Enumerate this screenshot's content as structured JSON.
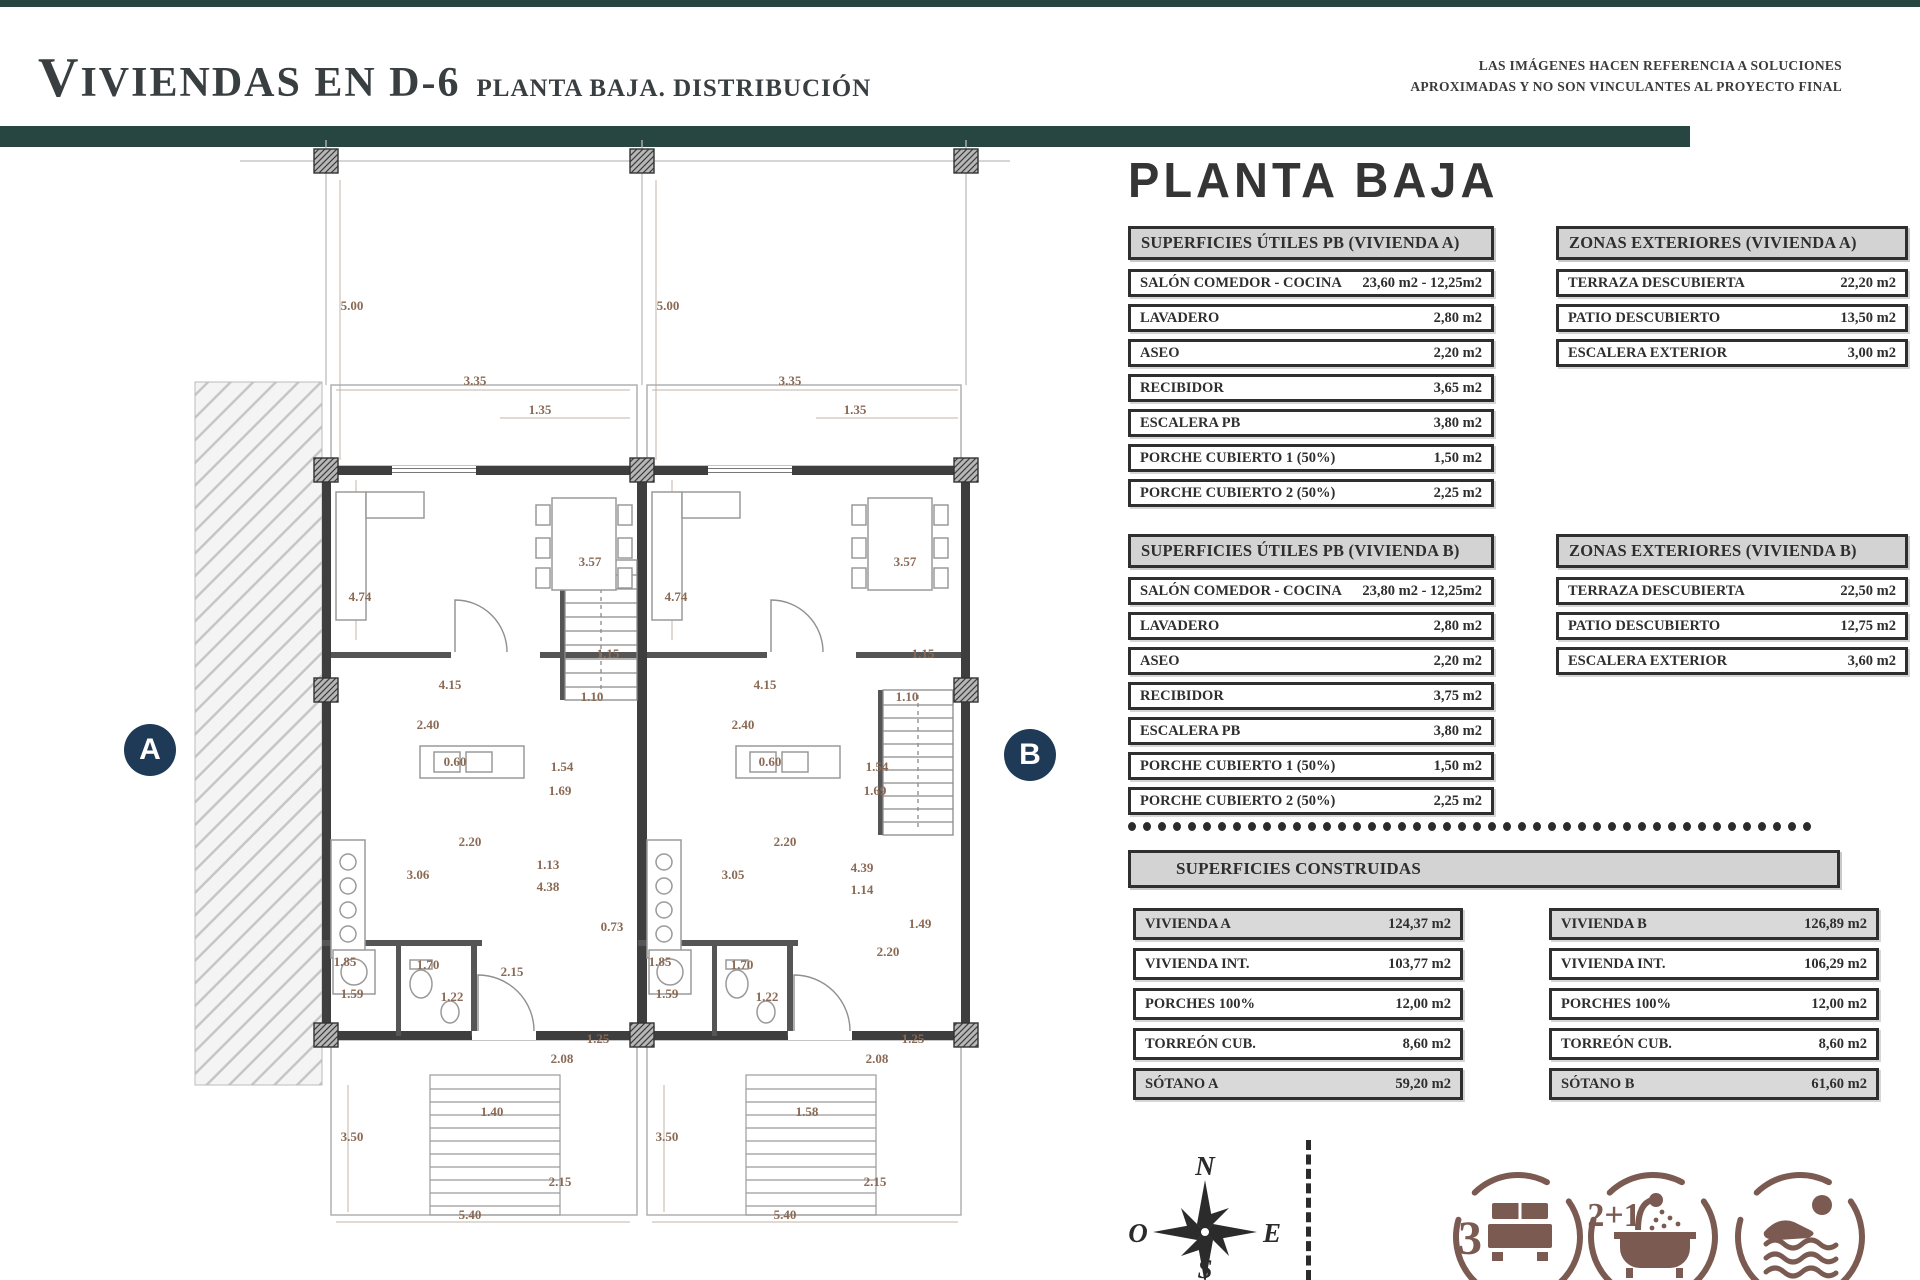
{
  "header": {
    "title_main": "VIVIENDAS EN D-6",
    "title_sub": "PLANTA BAJA. DISTRIBUCIÓN",
    "disclaimer_line1": "LAS IMÁGENES HACEN REFERENCIA A SOLUCIONES",
    "disclaimer_line2": "APROXIMADAS Y NO SON VINCULANTES AL PROYECTO FINAL"
  },
  "panel": {
    "heading": "PLANTA BAJA",
    "tables": [
      {
        "id": "utiles_a",
        "title": "SUPERFICIES ÚTILES PB (VIVIENDA A)",
        "rows": [
          [
            "SALÓN COMEDOR - COCINA",
            "23,60 m2 - 12,25m2"
          ],
          [
            "LAVADERO",
            "2,80 m2"
          ],
          [
            "ASEO",
            "2,20 m2"
          ],
          [
            "RECIBIDOR",
            "3,65 m2"
          ],
          [
            "ESCALERA PB",
            "3,80 m2"
          ],
          [
            "PORCHE CUBIERTO 1 (50%)",
            "1,50 m2"
          ],
          [
            "PORCHE CUBIERTO 2 (50%)",
            "2,25 m2"
          ]
        ]
      },
      {
        "id": "zonas_a",
        "title": "ZONAS EXTERIORES (VIVIENDA A)",
        "rows": [
          [
            "TERRAZA DESCUBIERTA",
            "22,20 m2"
          ],
          [
            "PATIO DESCUBIERTO",
            "13,50 m2"
          ],
          [
            "ESCALERA EXTERIOR",
            "3,00 m2"
          ]
        ]
      },
      {
        "id": "utiles_b",
        "title": "SUPERFICIES ÚTILES PB (VIVIENDA B)",
        "rows": [
          [
            "SALÓN COMEDOR - COCINA",
            "23,80 m2 - 12,25m2"
          ],
          [
            "LAVADERO",
            "2,80 m2"
          ],
          [
            "ASEO",
            "2,20 m2"
          ],
          [
            "RECIBIDOR",
            "3,75 m2"
          ],
          [
            "ESCALERA PB",
            "3,80 m2"
          ],
          [
            "PORCHE CUBIERTO 1 (50%)",
            "1,50 m2"
          ],
          [
            "PORCHE CUBIERTO 2 (50%)",
            "2,25 m2"
          ]
        ]
      },
      {
        "id": "zonas_b",
        "title": "ZONAS EXTERIORES (VIVIENDA B)",
        "rows": [
          [
            "TERRAZA DESCUBIERTA",
            "22,50 m2"
          ],
          [
            "PATIO DESCUBIERTO",
            "12,75 m2"
          ],
          [
            "ESCALERA EXTERIOR",
            "3,60 m2"
          ]
        ]
      }
    ],
    "construidas": {
      "title": "SUPERFICIES CONSTRUIDAS",
      "col_a": [
        {
          "label": "VIVIENDA A",
          "value": "124,37 m2",
          "shaded": true
        },
        {
          "label": "VIVIENDA INT.",
          "value": "103,77 m2",
          "shaded": false
        },
        {
          "label": "PORCHES 100%",
          "value": "12,00 m2",
          "shaded": false
        },
        {
          "label": "TORREÓN CUB.",
          "value": "8,60 m2",
          "shaded": false
        },
        {
          "label": "SÓTANO A",
          "value": "59,20 m2",
          "shaded": true
        }
      ],
      "col_b": [
        {
          "label": "VIVIENDA B",
          "value": "126,89 m2",
          "shaded": true
        },
        {
          "label": "VIVIENDA INT.",
          "value": "106,29 m2",
          "shaded": false
        },
        {
          "label": "PORCHES 100%",
          "value": "12,00 m2",
          "shaded": false
        },
        {
          "label": "TORREÓN CUB.",
          "value": "8,60 m2",
          "shaded": false
        },
        {
          "label": "SÓTANO B",
          "value": "61,60 m2",
          "shaded": true
        }
      ]
    }
  },
  "plan": {
    "marker_a": "A",
    "marker_b": "B",
    "dimensions": [
      {
        "x": 352,
        "y": 310,
        "t": "5.00"
      },
      {
        "x": 668,
        "y": 310,
        "t": "5.00"
      },
      {
        "x": 475,
        "y": 385,
        "t": "3.35"
      },
      {
        "x": 790,
        "y": 385,
        "t": "3.35"
      },
      {
        "x": 540,
        "y": 414,
        "t": "1.35"
      },
      {
        "x": 855,
        "y": 414,
        "t": "1.35"
      },
      {
        "x": 590,
        "y": 566,
        "t": "3.57"
      },
      {
        "x": 905,
        "y": 566,
        "t": "3.57"
      },
      {
        "x": 360,
        "y": 601,
        "t": "4.74"
      },
      {
        "x": 676,
        "y": 601,
        "t": "4.74"
      },
      {
        "x": 608,
        "y": 658,
        "t": "1.15"
      },
      {
        "x": 923,
        "y": 658,
        "t": "1.15"
      },
      {
        "x": 450,
        "y": 689,
        "t": "4.15"
      },
      {
        "x": 765,
        "y": 689,
        "t": "4.15"
      },
      {
        "x": 592,
        "y": 701,
        "t": "1.10"
      },
      {
        "x": 907,
        "y": 701,
        "t": "1.10"
      },
      {
        "x": 428,
        "y": 729,
        "t": "2.40"
      },
      {
        "x": 743,
        "y": 729,
        "t": "2.40"
      },
      {
        "x": 455,
        "y": 766,
        "t": "0.60"
      },
      {
        "x": 770,
        "y": 766,
        "t": "0.60"
      },
      {
        "x": 562,
        "y": 771,
        "t": "1.54"
      },
      {
        "x": 877,
        "y": 771,
        "t": "1.54"
      },
      {
        "x": 560,
        "y": 795,
        "t": "1.69"
      },
      {
        "x": 875,
        "y": 795,
        "t": "1.69"
      },
      {
        "x": 470,
        "y": 846,
        "t": "2.20"
      },
      {
        "x": 785,
        "y": 846,
        "t": "2.20"
      },
      {
        "x": 418,
        "y": 879,
        "t": "3.06"
      },
      {
        "x": 733,
        "y": 879,
        "t": "3.05"
      },
      {
        "x": 548,
        "y": 869,
        "t": "1.13"
      },
      {
        "x": 862,
        "y": 872,
        "t": "4.39"
      },
      {
        "x": 548,
        "y": 891,
        "t": "4.38"
      },
      {
        "x": 862,
        "y": 894,
        "t": "1.14"
      },
      {
        "x": 612,
        "y": 931,
        "t": "0.73"
      },
      {
        "x": 920,
        "y": 928,
        "t": "1.49"
      },
      {
        "x": 888,
        "y": 956,
        "t": "2.20"
      },
      {
        "x": 345,
        "y": 966,
        "t": "1.85"
      },
      {
        "x": 660,
        "y": 966,
        "t": "1.85"
      },
      {
        "x": 428,
        "y": 969,
        "t": "1.70"
      },
      {
        "x": 742,
        "y": 969,
        "t": "1.70"
      },
      {
        "x": 512,
        "y": 976,
        "t": "2.15"
      },
      {
        "x": 352,
        "y": 998,
        "t": "1.59"
      },
      {
        "x": 667,
        "y": 998,
        "t": "1.59"
      },
      {
        "x": 452,
        "y": 1001,
        "t": "1.22"
      },
      {
        "x": 767,
        "y": 1001,
        "t": "1.22"
      },
      {
        "x": 598,
        "y": 1043,
        "t": "1.25"
      },
      {
        "x": 913,
        "y": 1043,
        "t": "1.25"
      },
      {
        "x": 562,
        "y": 1063,
        "t": "2.08"
      },
      {
        "x": 877,
        "y": 1063,
        "t": "2.08"
      },
      {
        "x": 492,
        "y": 1116,
        "t": "1.40"
      },
      {
        "x": 807,
        "y": 1116,
        "t": "1.58"
      },
      {
        "x": 352,
        "y": 1141,
        "t": "3.50"
      },
      {
        "x": 667,
        "y": 1141,
        "t": "3.50"
      },
      {
        "x": 560,
        "y": 1186,
        "t": "2.15"
      },
      {
        "x": 875,
        "y": 1186,
        "t": "2.15"
      },
      {
        "x": 470,
        "y": 1219,
        "t": "5.40"
      },
      {
        "x": 785,
        "y": 1219,
        "t": "5.40"
      }
    ]
  },
  "footer": {
    "compass": {
      "n": "N",
      "e": "E",
      "s": "S",
      "o": "O"
    },
    "badges": [
      {
        "count": "3",
        "icon": "bed-icon"
      },
      {
        "count": "2+1",
        "icon": "bath-icon"
      },
      {
        "count": "",
        "icon": "pool-icon"
      }
    ]
  },
  "colors": {
    "teal": "#274541",
    "navy": "#1f3a56",
    "icon": "#7b5a52",
    "dim": "#8a6a55"
  }
}
